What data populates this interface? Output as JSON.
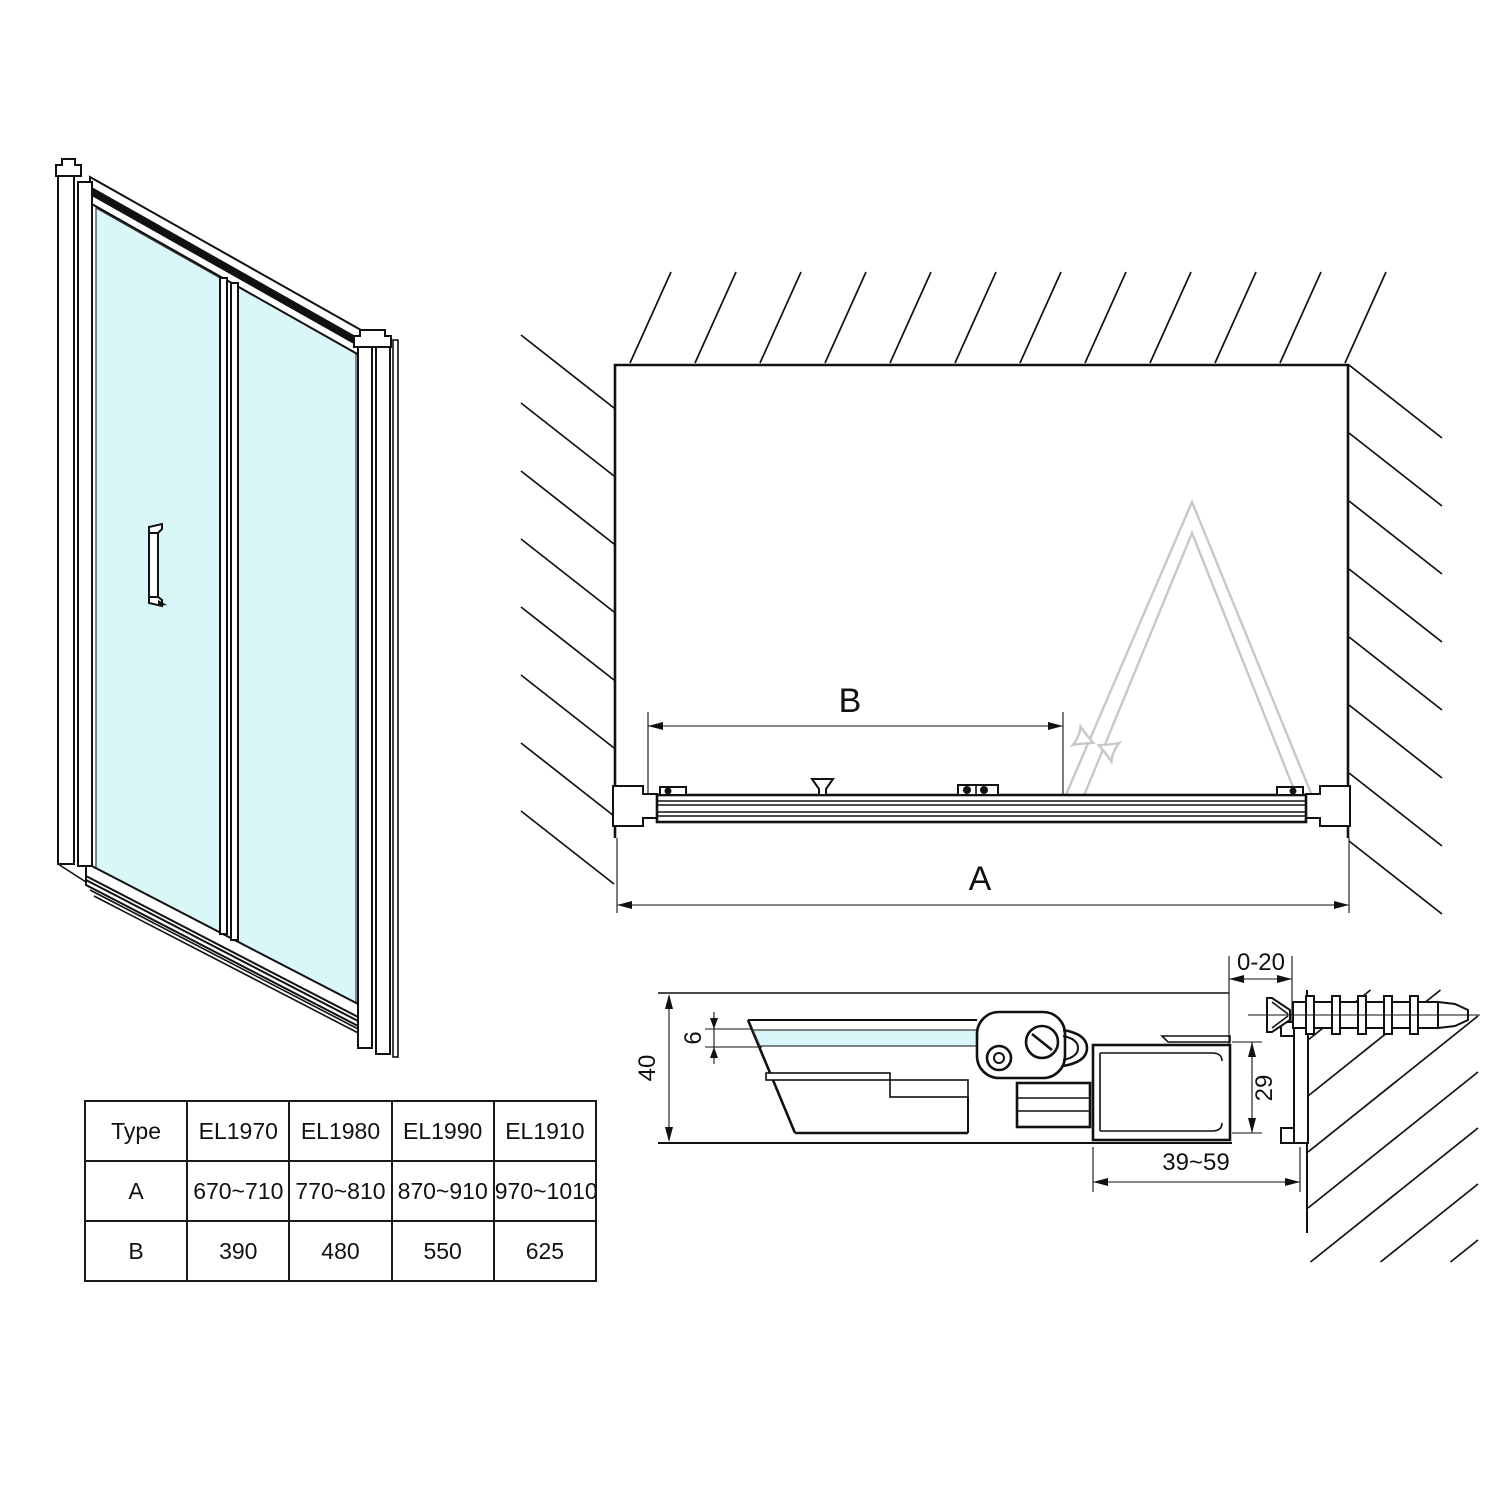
{
  "plan": {
    "dim_a": "A",
    "dim_b": "B"
  },
  "section": {
    "dim_wall_offset": "0-20",
    "dim_glass": "6",
    "dim_total": "40",
    "dim_profile": "29",
    "dim_range": "39~59"
  },
  "table": {
    "columns": [
      "Type",
      "EL1970",
      "EL1980",
      "EL1990",
      "EL1910"
    ],
    "rows": [
      {
        "label": "A",
        "values": [
          "670~710",
          "770~810",
          "870~910",
          "970~1010"
        ]
      },
      {
        "label": "B",
        "values": [
          "390",
          "480",
          "550",
          "625"
        ]
      }
    ]
  },
  "colors": {
    "glass": "#d9f6f8",
    "line": "#111111",
    "ghost": "#c8c8c8"
  }
}
